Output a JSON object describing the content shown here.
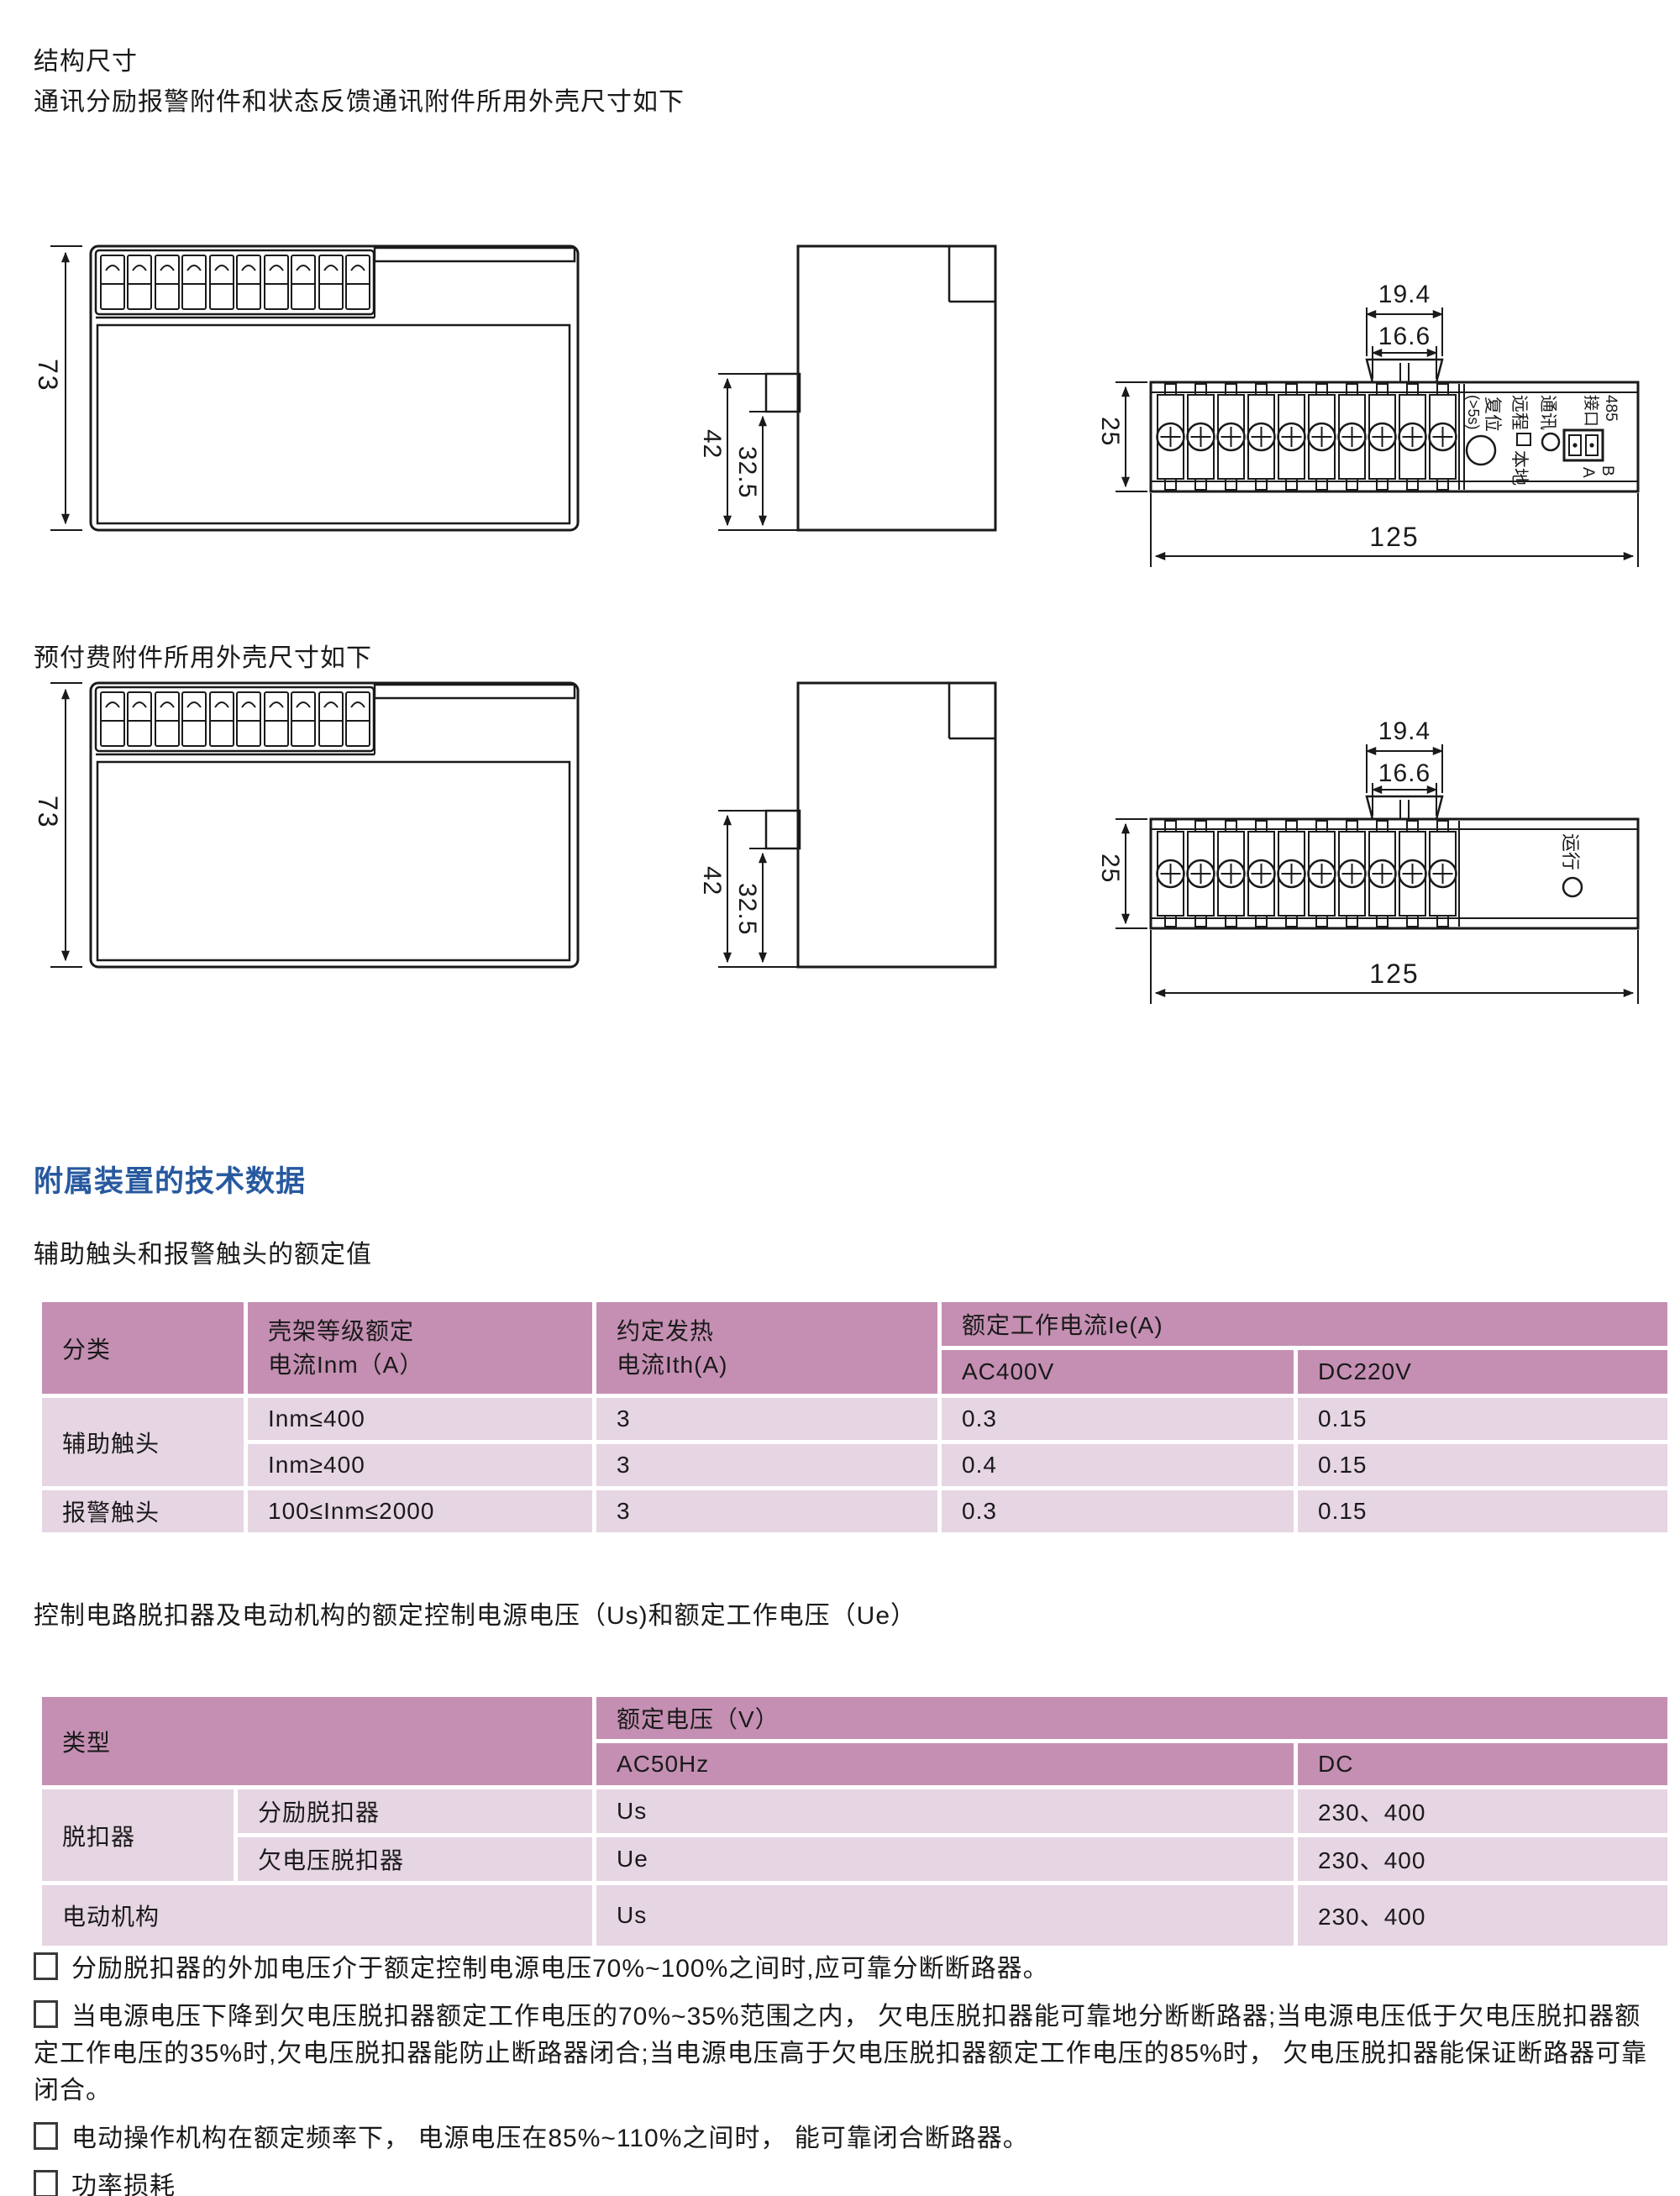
{
  "titles": {
    "t1a": "结构尺寸",
    "t1b": "通讯分励报警附件和状态反馈通讯附件所用外壳尺寸如下",
    "t2": "预付费附件所用外壳尺寸如下",
    "tech_heading": "附属装置的技术数据",
    "aux_caption": "辅助触头和报警触头的额定值",
    "trip_caption": "控制电路脱扣器及电动机构的额定控制电源电压（Us)和额定工作电压（Ue）"
  },
  "dims": {
    "h": "73",
    "d1": "42",
    "d2": "32.5",
    "w1": "19.4",
    "w2": "16.6",
    "bh": "25",
    "bw": "125"
  },
  "panel_comm": {
    "l485": "485",
    "lport": "接口",
    "b": "B",
    "a": "A",
    "comm": "通讯",
    "remote": "远程",
    "local": "本地",
    "reset": "复位",
    "reset_s": "(>5s)"
  },
  "panel_prepay": {
    "run": "运行"
  },
  "aux_table": {
    "h_class": "分类",
    "h_frame": [
      "壳架等级额定",
      "电流Inm（A）"
    ],
    "h_thermal": [
      "约定发热",
      "电流Ith(A)"
    ],
    "h_ie": "额定工作电流Ie(A)",
    "h_ac": "AC400V",
    "h_dc": "DC220V",
    "rows": [
      {
        "c0": "辅助触头",
        "c1": "Inm≤400",
        "c2": "3",
        "c3": "0.3",
        "c4": "0.15"
      },
      {
        "c1": "Inm≥400",
        "c2": "3",
        "c3": "0.4",
        "c4": "0.15"
      },
      {
        "c0": "报警触头",
        "c1": "100≤Inm≤2000",
        "c2": "3",
        "c3": "0.3",
        "c4": "0.15"
      }
    ]
  },
  "trip_table": {
    "h_type": "类型",
    "h_v": "额定电压（V）",
    "h_ac": "AC50Hz",
    "h_dc": "DC",
    "rows": [
      {
        "c0": "脱扣器",
        "c1": "分励脱扣器",
        "c2": "Us",
        "c3": "230、400",
        "c4": "24"
      },
      {
        "c1": "欠电压脱扣器",
        "c2": "Ue",
        "c3": "230、400",
        "c4": "——"
      },
      {
        "c0": "电动机构",
        "c2": "Us",
        "c3": "230、400",
        "c4": "110、220"
      }
    ]
  },
  "notes": [
    "分励脱扣器的外加电压介于额定控制电源电压70%~100%之间时,应可靠分断断路器。",
    "当电源电压下降到欠电压脱扣器额定工作电压的70%~35%范围之内， 欠电压脱扣器能可靠地分断断路器;当电源电压低于欠电压脱扣器额定工作电压的35%时,欠电压脱扣器能防止断路器闭合;当电源电压高于欠电压脱扣器额定工作电压的85%时， 欠电压脱扣器能保证断路器可靠闭合。",
    "电动操作机构在额定频率下， 电源电压在85%~110%之间时， 能可靠闭合断路器。",
    "功率损耗"
  ],
  "colors": {
    "accent_blue": "#27599f",
    "table_header": "#c48fb2",
    "table_row": "#e6d5e3"
  }
}
